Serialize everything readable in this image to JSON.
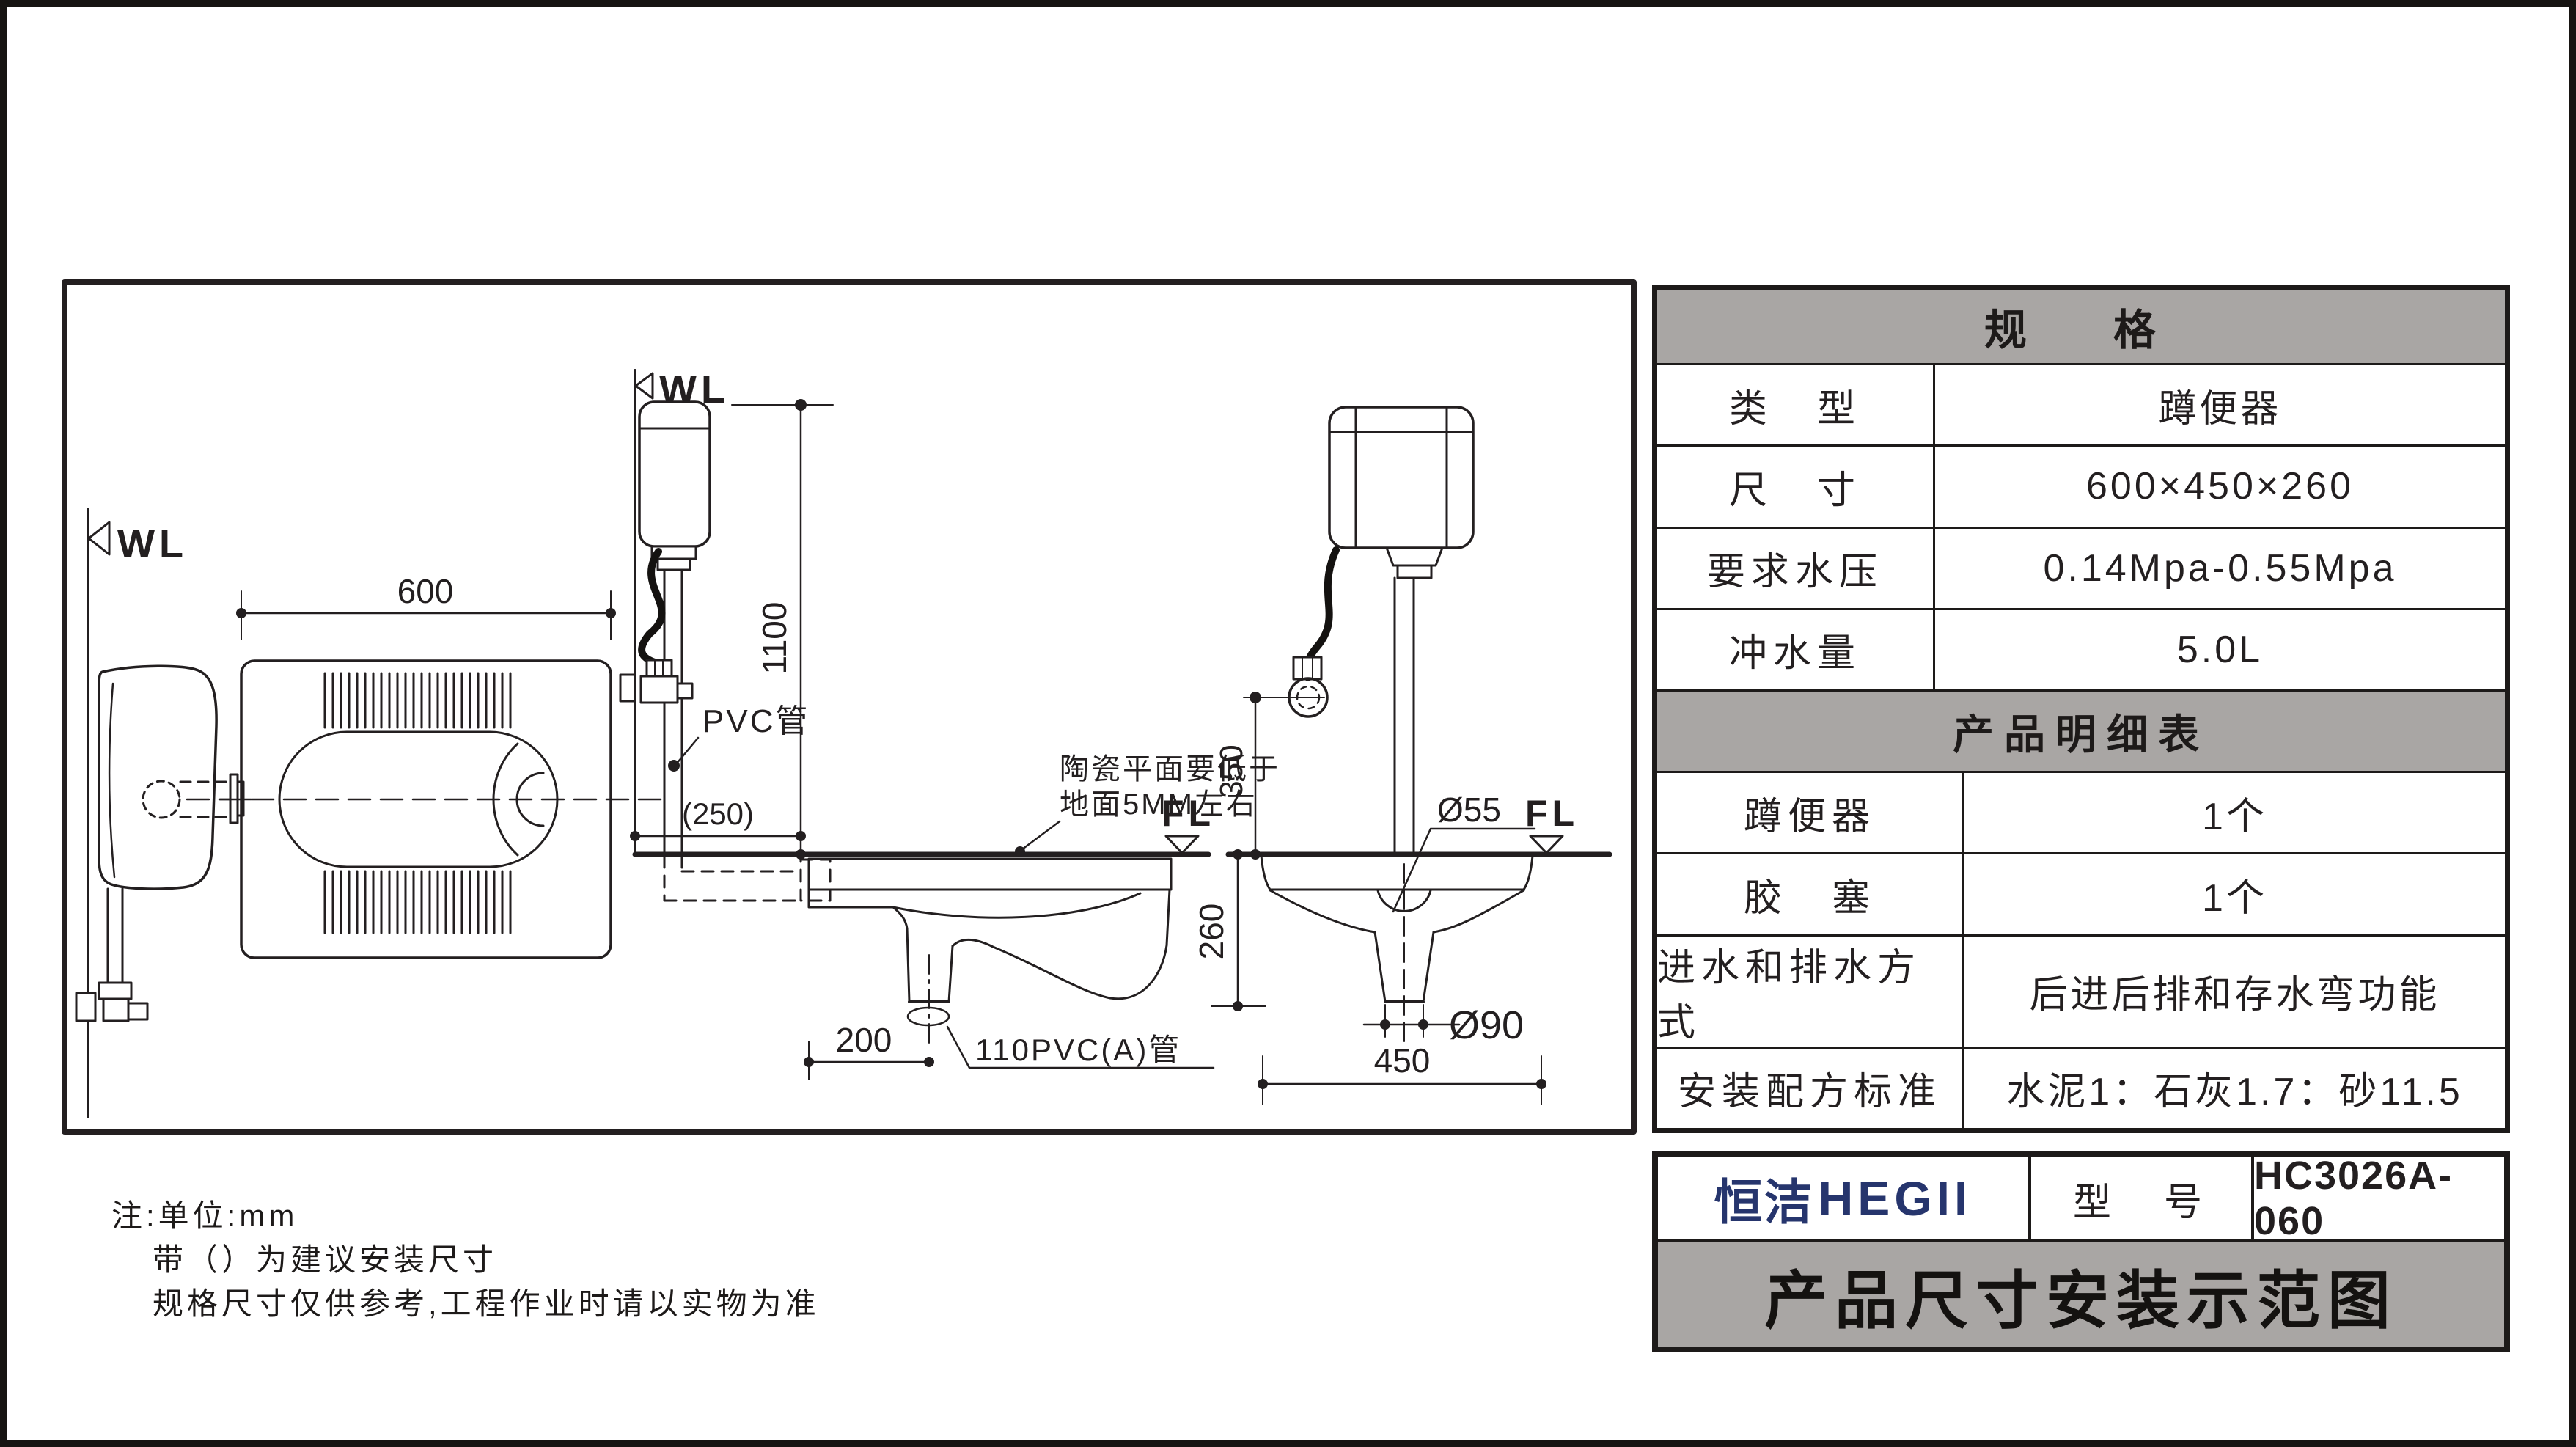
{
  "palette": {
    "ink": "#231f20",
    "grey_band": "#a9a6a4",
    "brand_navy": "#26356d",
    "paper": "#ffffff"
  },
  "drawing": {
    "markers": {
      "wl": "WL",
      "fl": "FL"
    },
    "dims": {
      "plan_width": "600",
      "height_1100": "1100",
      "offset_250": "(250)",
      "outlet_200": "200",
      "height_260": "260",
      "inlet_height_350": "350",
      "front_width_450": "450",
      "dia_55": "Ø55",
      "dia_90": "Ø90"
    },
    "labels": {
      "pvc_pipe": "PVC管",
      "pvc110_pipe": "110PVC(A)管",
      "ceramic_note_line1": "陶瓷平面要低于",
      "ceramic_note_line2": "地面5MM左右"
    }
  },
  "spec_table": {
    "title": "规　格",
    "rows": [
      {
        "label": "类　型",
        "value": "蹲便器"
      },
      {
        "label": "尺　寸",
        "value": "600×450×260"
      },
      {
        "label": "要求水压",
        "value": "0.14Mpa-0.55Mpa"
      },
      {
        "label": "冲水量",
        "value": "5.0L"
      }
    ]
  },
  "detail_table": {
    "title": "产品明细表",
    "rows": [
      {
        "label": "蹲便器",
        "value": "1个"
      },
      {
        "label": "胶　塞",
        "value": "1个"
      },
      {
        "label": "进水和排水方式",
        "value": "后进后排和存水弯功能"
      },
      {
        "label": "安装配方标准",
        "value": "水泥1：石灰1.7：砂11.5"
      }
    ]
  },
  "title_block": {
    "brand_cn": "恒洁",
    "brand_en": "HEGII",
    "model_label": "型　号",
    "model_value": "HC3026A-060",
    "sheet_title": "产品尺寸安装示范图"
  },
  "notes": {
    "line1": "注:单位:mm",
    "line2": "带（）为建议安装尺寸",
    "line3": "规格尺寸仅供参考,工程作业时请以实物为准"
  }
}
